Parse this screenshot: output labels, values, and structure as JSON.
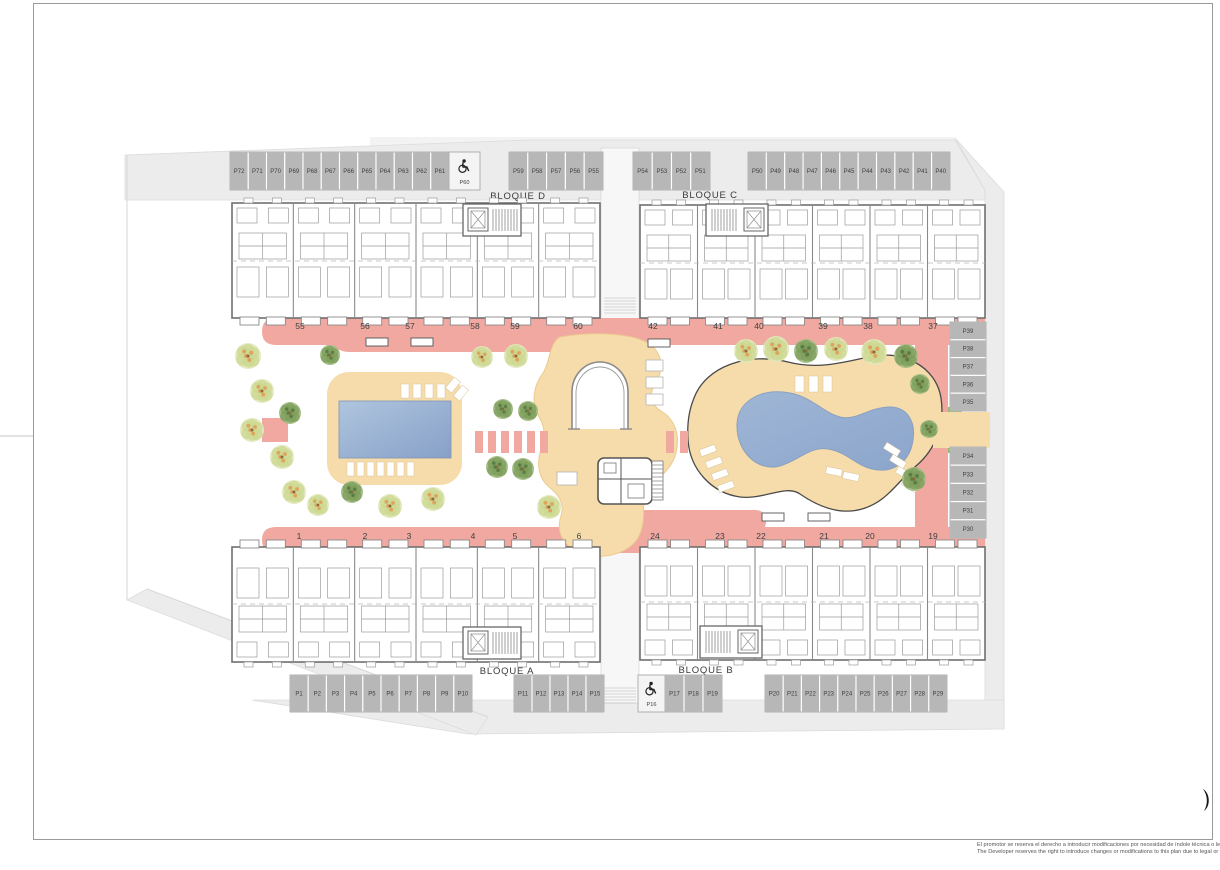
{
  "page": {
    "disclaimer_es": "El promotor se reserva el derecho a introducir modificaciones por necesidad de índole técnica o legal",
    "disclaimer_en": "The Developer reserves the right to introduce changes or modifications to this plan due to legal or technical"
  },
  "blocks": [
    {
      "id": "bloque-d",
      "label": "BLOQUE D"
    },
    {
      "id": "bloque-c",
      "label": "BLOQUE C"
    },
    {
      "id": "bloque-a",
      "label": "BLOQUE A"
    },
    {
      "id": "bloque-b",
      "label": "BLOQUE B"
    }
  ],
  "units": {
    "top_left": [
      "55",
      "56",
      "57",
      "58",
      "59",
      "60"
    ],
    "top_right": [
      "42",
      "41",
      "40",
      "39",
      "38",
      "37"
    ],
    "bottom_left": [
      "1",
      "2",
      "3",
      "4",
      "5",
      "6"
    ],
    "bottom_right": [
      "24",
      "23",
      "22",
      "21",
      "20",
      "19"
    ]
  },
  "parking": {
    "top_left": [
      "P72",
      "P71",
      "P70",
      "P69",
      "P68",
      "P67",
      "P66",
      "P65",
      "P64",
      "P63",
      "P62",
      "P61"
    ],
    "top_accessible": "P60",
    "top_mid_1": [
      "P59",
      "P58",
      "P57",
      "P56",
      "P55"
    ],
    "top_mid_2": [
      "P54",
      "P53",
      "P52",
      "P51"
    ],
    "top_right": [
      "P50",
      "P49",
      "P48",
      "P47",
      "P46",
      "P45",
      "P44",
      "P43",
      "P42",
      "P41",
      "P40"
    ],
    "right_upper": [
      "P39",
      "P38",
      "P37",
      "P36",
      "P35"
    ],
    "right_lower": [
      "P34",
      "P33",
      "P32",
      "P31",
      "P30"
    ],
    "bottom_left": [
      "P1",
      "P2",
      "P3",
      "P4",
      "P5",
      "P6",
      "P7",
      "P8",
      "P9",
      "P10"
    ],
    "bottom_mid_1": [
      "P11",
      "P12",
      "P13",
      "P14",
      "P15"
    ],
    "bottom_accessible": "P16",
    "bottom_mid_2": [
      "P17",
      "P18",
      "P19"
    ],
    "bottom_right": [
      "P20",
      "P21",
      "P22",
      "P23",
      "P24",
      "P25",
      "P26",
      "P27",
      "P28",
      "P29"
    ]
  },
  "icons": {
    "accessible_parking": "wheelchair-icon"
  },
  "colors": {
    "promenade_pink": "#F0A8A1",
    "deck_tan": "#F6DCAB",
    "pool_blue_light": "#A9C0DC",
    "pool_blue_dark": "#8AA3C9",
    "parking_gray": "#B7B7B7",
    "road_gray": "#ECECEC",
    "wall_gray": "#6F6F6F",
    "tree_green": "#7D9E5B",
    "tree_autumn": "#CCD892",
    "hedge_green": "#8FBB6A"
  }
}
